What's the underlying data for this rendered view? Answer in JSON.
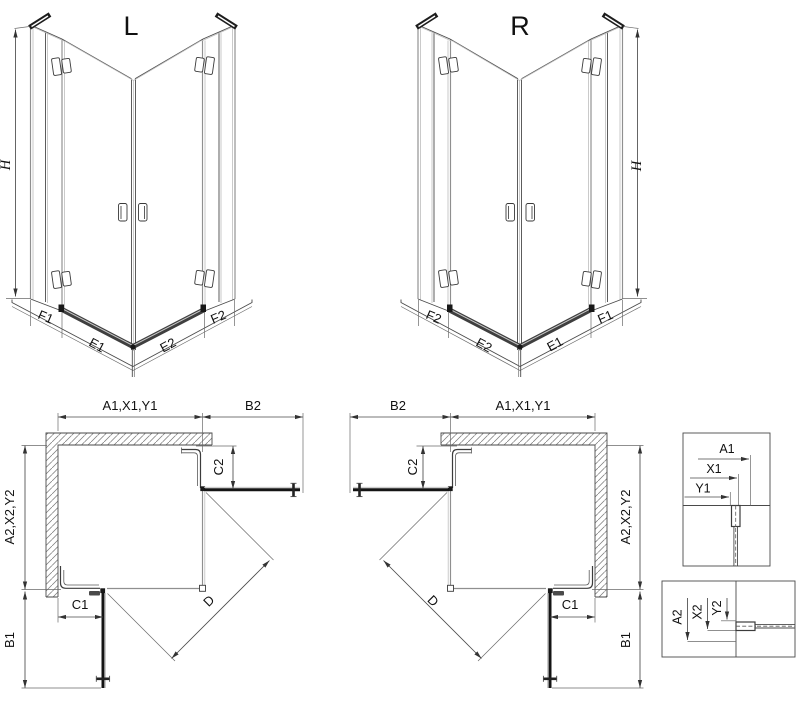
{
  "drawing": {
    "views": {
      "l": {
        "title": "L",
        "height": "H",
        "f1": "F1",
        "e1": "E1",
        "e2": "E2",
        "f2": "F2"
      },
      "r": {
        "title": "R",
        "height": "H",
        "f1": "F1",
        "e1": "E1",
        "e2": "E2",
        "f2": "F2"
      },
      "plan_l": {
        "a1": "A1,X1,Y1",
        "b2": "B2",
        "c2": "C2",
        "a2": "A2,X2,Y2",
        "b1": "B1",
        "c1": "C1",
        "d": "D"
      },
      "plan_r": {
        "a1": "A1,X1,Y1",
        "b2": "B2",
        "c2": "C2",
        "a2": "A2,X2,Y2",
        "b1": "B1",
        "c1": "C1",
        "d": "D"
      },
      "detail1": {
        "a1": "A1",
        "x1": "X1",
        "y1": "Y1"
      },
      "detail2": {
        "a2": "A2",
        "x2": "X2",
        "y2": "Y2"
      }
    },
    "colors": {
      "line": "#4a4a4a",
      "door": "#141414",
      "glass": "#8f8f8f",
      "threshold": "#3f3f3f"
    }
  }
}
